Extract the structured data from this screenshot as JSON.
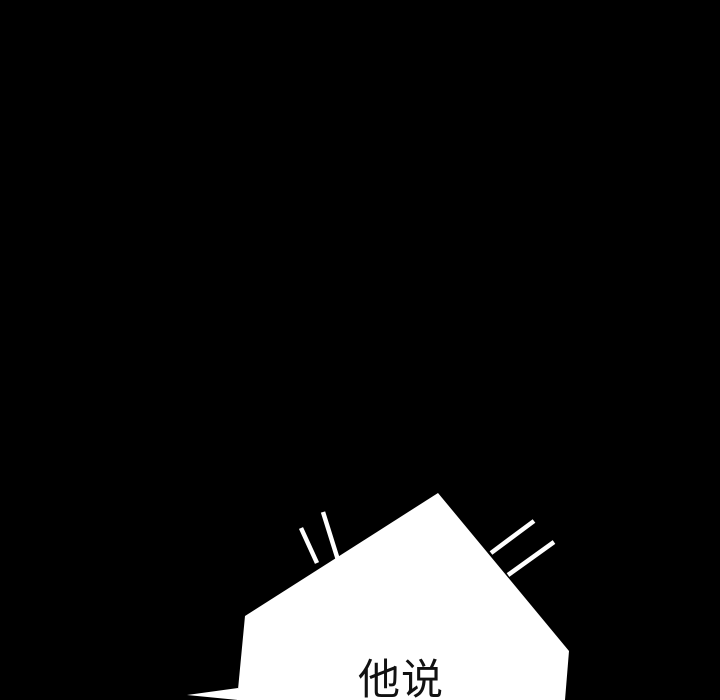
{
  "panel": {
    "type_label": "comic-panel"
  },
  "bubble": {
    "text": "他说"
  },
  "colors": {
    "background": "#000000",
    "bubble_fill": "#ffffff",
    "text": "#111111",
    "emphasis_line": "#ffffff"
  }
}
